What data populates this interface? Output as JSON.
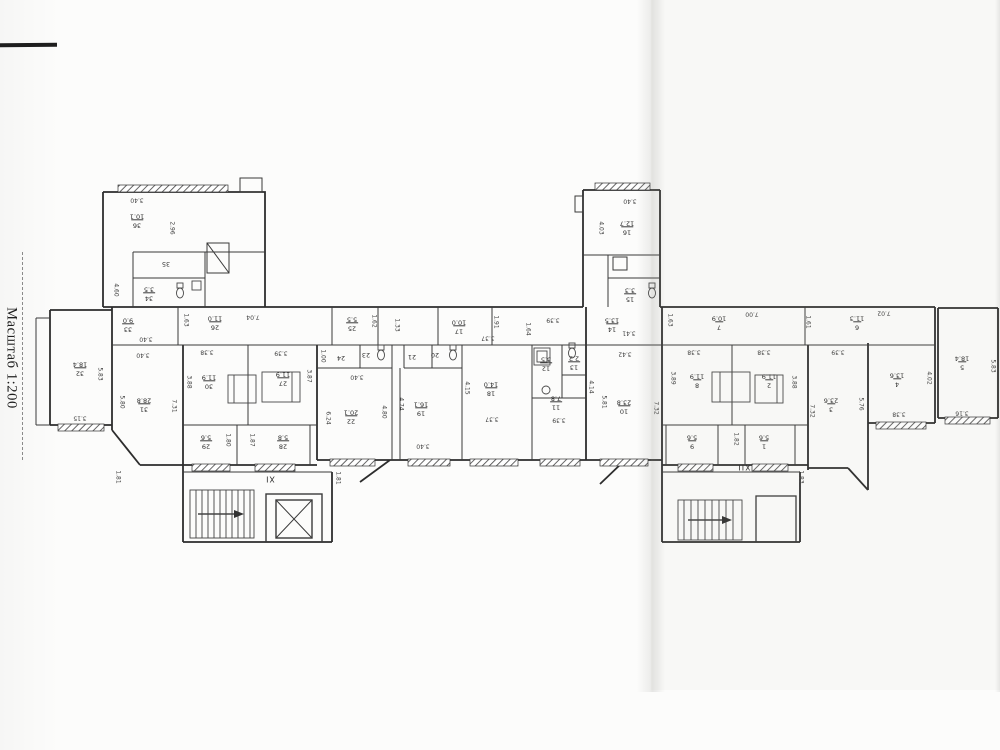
{
  "meta": {
    "scale_label": "Масштаб 1:200"
  },
  "plan": {
    "stairwells": [
      {
        "label": "XI",
        "x": 270,
        "y": 479
      },
      {
        "label": "XII",
        "x": 744,
        "y": 467
      }
    ],
    "rooms": [
      {
        "num": "36",
        "area": "10.1",
        "x": 137,
        "y": 220
      },
      {
        "num": "35",
        "area": "",
        "x": 166,
        "y": 263
      },
      {
        "num": "34",
        "area": "3.5",
        "x": 149,
        "y": 293
      },
      {
        "num": "33",
        "area": "9.0",
        "x": 128,
        "y": 324
      },
      {
        "num": "32",
        "area": "18.4",
        "x": 80,
        "y": 368
      },
      {
        "num": "31",
        "area": "28.8",
        "x": 144,
        "y": 404
      },
      {
        "num": "26",
        "area": "11.0",
        "x": 215,
        "y": 322
      },
      {
        "num": "30",
        "area": "11.9",
        "x": 209,
        "y": 381
      },
      {
        "num": "27",
        "area": "11.9",
        "x": 283,
        "y": 378
      },
      {
        "num": "29",
        "area": "5.6",
        "x": 206,
        "y": 441
      },
      {
        "num": "28",
        "area": "5.8",
        "x": 283,
        "y": 441
      },
      {
        "num": "25",
        "area": "5.5",
        "x": 352,
        "y": 323
      },
      {
        "num": "24",
        "area": "",
        "x": 341,
        "y": 357
      },
      {
        "num": "23",
        "area": "",
        "x": 366,
        "y": 354
      },
      {
        "num": "22",
        "area": "20.1",
        "x": 351,
        "y": 416
      },
      {
        "num": "21",
        "area": "",
        "x": 412,
        "y": 356
      },
      {
        "num": "20",
        "area": "",
        "x": 435,
        "y": 354
      },
      {
        "num": "19",
        "area": "16.1",
        "x": 421,
        "y": 408
      },
      {
        "num": "17",
        "area": "10.0",
        "x": 459,
        "y": 326
      },
      {
        "num": "18",
        "area": "14.0",
        "x": 491,
        "y": 388
      },
      {
        "num": "12",
        "area": "3.5",
        "x": 546,
        "y": 363
      },
      {
        "num": "13",
        "area": "2.2",
        "x": 574,
        "y": 362
      },
      {
        "num": "11",
        "area": "7.8",
        "x": 556,
        "y": 402
      },
      {
        "num": "14",
        "area": "13.5",
        "x": 612,
        "y": 324
      },
      {
        "num": "16",
        "area": "12.7",
        "x": 627,
        "y": 227
      },
      {
        "num": "15",
        "area": "3.3",
        "x": 630,
        "y": 294
      },
      {
        "num": "7",
        "area": "10.9",
        "x": 719,
        "y": 322
      },
      {
        "num": "10",
        "area": "23.8",
        "x": 624,
        "y": 406
      },
      {
        "num": "8",
        "area": "11.9",
        "x": 697,
        "y": 380
      },
      {
        "num": "2",
        "area": "11.9",
        "x": 769,
        "y": 380
      },
      {
        "num": "9",
        "area": "5.6",
        "x": 692,
        "y": 441
      },
      {
        "num": "1",
        "area": "5.6",
        "x": 764,
        "y": 441
      },
      {
        "num": "6",
        "area": "11.3",
        "x": 857,
        "y": 322
      },
      {
        "num": "3",
        "area": "23.6",
        "x": 831,
        "y": 404
      },
      {
        "num": "4",
        "area": "13.6",
        "x": 897,
        "y": 379
      },
      {
        "num": "5",
        "area": "18.4",
        "x": 962,
        "y": 362
      }
    ],
    "dims": [
      {
        "t": "3.40",
        "x": 137,
        "y": 200
      },
      {
        "t": "2.96",
        "x": 172,
        "y": 228,
        "v": 1
      },
      {
        "t": "4.60",
        "x": 116,
        "y": 290,
        "v": 1
      },
      {
        "t": "3.40",
        "x": 146,
        "y": 339
      },
      {
        "t": "3.40",
        "x": 143,
        "y": 355
      },
      {
        "t": "1.63",
        "x": 186,
        "y": 320,
        "v": 1
      },
      {
        "t": "3.15",
        "x": 80,
        "y": 418
      },
      {
        "t": "5.83",
        "x": 100,
        "y": 374,
        "v": 1
      },
      {
        "t": "5.80",
        "x": 122,
        "y": 402,
        "v": 1
      },
      {
        "t": "7.31",
        "x": 174,
        "y": 406,
        "v": 1
      },
      {
        "t": "7.04",
        "x": 253,
        "y": 317
      },
      {
        "t": "3.38",
        "x": 207,
        "y": 352
      },
      {
        "t": "3.39",
        "x": 281,
        "y": 353
      },
      {
        "t": "3.88",
        "x": 189,
        "y": 382,
        "v": 1
      },
      {
        "t": "3.87",
        "x": 309,
        "y": 376,
        "v": 1
      },
      {
        "t": "1.80",
        "x": 228,
        "y": 440,
        "v": 1
      },
      {
        "t": "1.87",
        "x": 252,
        "y": 440,
        "v": 1
      },
      {
        "t": "1.81",
        "x": 338,
        "y": 478,
        "v": 1
      },
      {
        "t": "1.81",
        "x": 118,
        "y": 477,
        "v": 1
      },
      {
        "t": "1.62",
        "x": 374,
        "y": 321,
        "v": 1
      },
      {
        "t": "1.33",
        "x": 397,
        "y": 325,
        "v": 1
      },
      {
        "t": "1.00",
        "x": 323,
        "y": 356,
        "v": 1
      },
      {
        "t": "6.24",
        "x": 328,
        "y": 418,
        "v": 1
      },
      {
        "t": "3.40",
        "x": 357,
        "y": 377
      },
      {
        "t": "4.80",
        "x": 384,
        "y": 412,
        "v": 1
      },
      {
        "t": "4.74",
        "x": 401,
        "y": 404,
        "v": 1
      },
      {
        "t": "3.40",
        "x": 423,
        "y": 446
      },
      {
        "t": "1.91",
        "x": 496,
        "y": 322,
        "v": 1
      },
      {
        "t": "3.37",
        "x": 488,
        "y": 338
      },
      {
        "t": "4.15",
        "x": 467,
        "y": 388,
        "v": 1
      },
      {
        "t": "3.37",
        "x": 492,
        "y": 419
      },
      {
        "t": "3.39",
        "x": 553,
        "y": 320
      },
      {
        "t": "1.64",
        "x": 528,
        "y": 329,
        "v": 1
      },
      {
        "t": "3.39",
        "x": 559,
        "y": 420
      },
      {
        "t": "4.14",
        "x": 591,
        "y": 387,
        "v": 1
      },
      {
        "t": "5.81",
        "x": 604,
        "y": 402,
        "v": 1
      },
      {
        "t": "3.41",
        "x": 629,
        "y": 333
      },
      {
        "t": "3.42",
        "x": 625,
        "y": 354
      },
      {
        "t": "3.40",
        "x": 630,
        "y": 201
      },
      {
        "t": "4.03",
        "x": 601,
        "y": 228,
        "v": 1
      },
      {
        "t": "1.63",
        "x": 670,
        "y": 320,
        "v": 1
      },
      {
        "t": "7.00",
        "x": 752,
        "y": 314
      },
      {
        "t": "1.61",
        "x": 808,
        "y": 322,
        "v": 1
      },
      {
        "t": "7.02",
        "x": 884,
        "y": 313
      },
      {
        "t": "3.38",
        "x": 694,
        "y": 352
      },
      {
        "t": "3.38",
        "x": 764,
        "y": 352
      },
      {
        "t": "3.89",
        "x": 673,
        "y": 378,
        "v": 1
      },
      {
        "t": "3.88",
        "x": 794,
        "y": 382,
        "v": 1
      },
      {
        "t": "7.32",
        "x": 656,
        "y": 408,
        "v": 1
      },
      {
        "t": "1.82",
        "x": 736,
        "y": 439,
        "v": 1
      },
      {
        "t": "1.83",
        "x": 801,
        "y": 477,
        "v": 1
      },
      {
        "t": "3.39",
        "x": 838,
        "y": 352
      },
      {
        "t": "7.32",
        "x": 812,
        "y": 411,
        "v": 1
      },
      {
        "t": "5.76",
        "x": 861,
        "y": 404,
        "v": 1
      },
      {
        "t": "4.02",
        "x": 929,
        "y": 378,
        "v": 1
      },
      {
        "t": "3.38",
        "x": 899,
        "y": 414
      },
      {
        "t": "5.83",
        "x": 993,
        "y": 366,
        "v": 1
      },
      {
        "t": "3.16",
        "x": 962,
        "y": 413
      }
    ]
  }
}
